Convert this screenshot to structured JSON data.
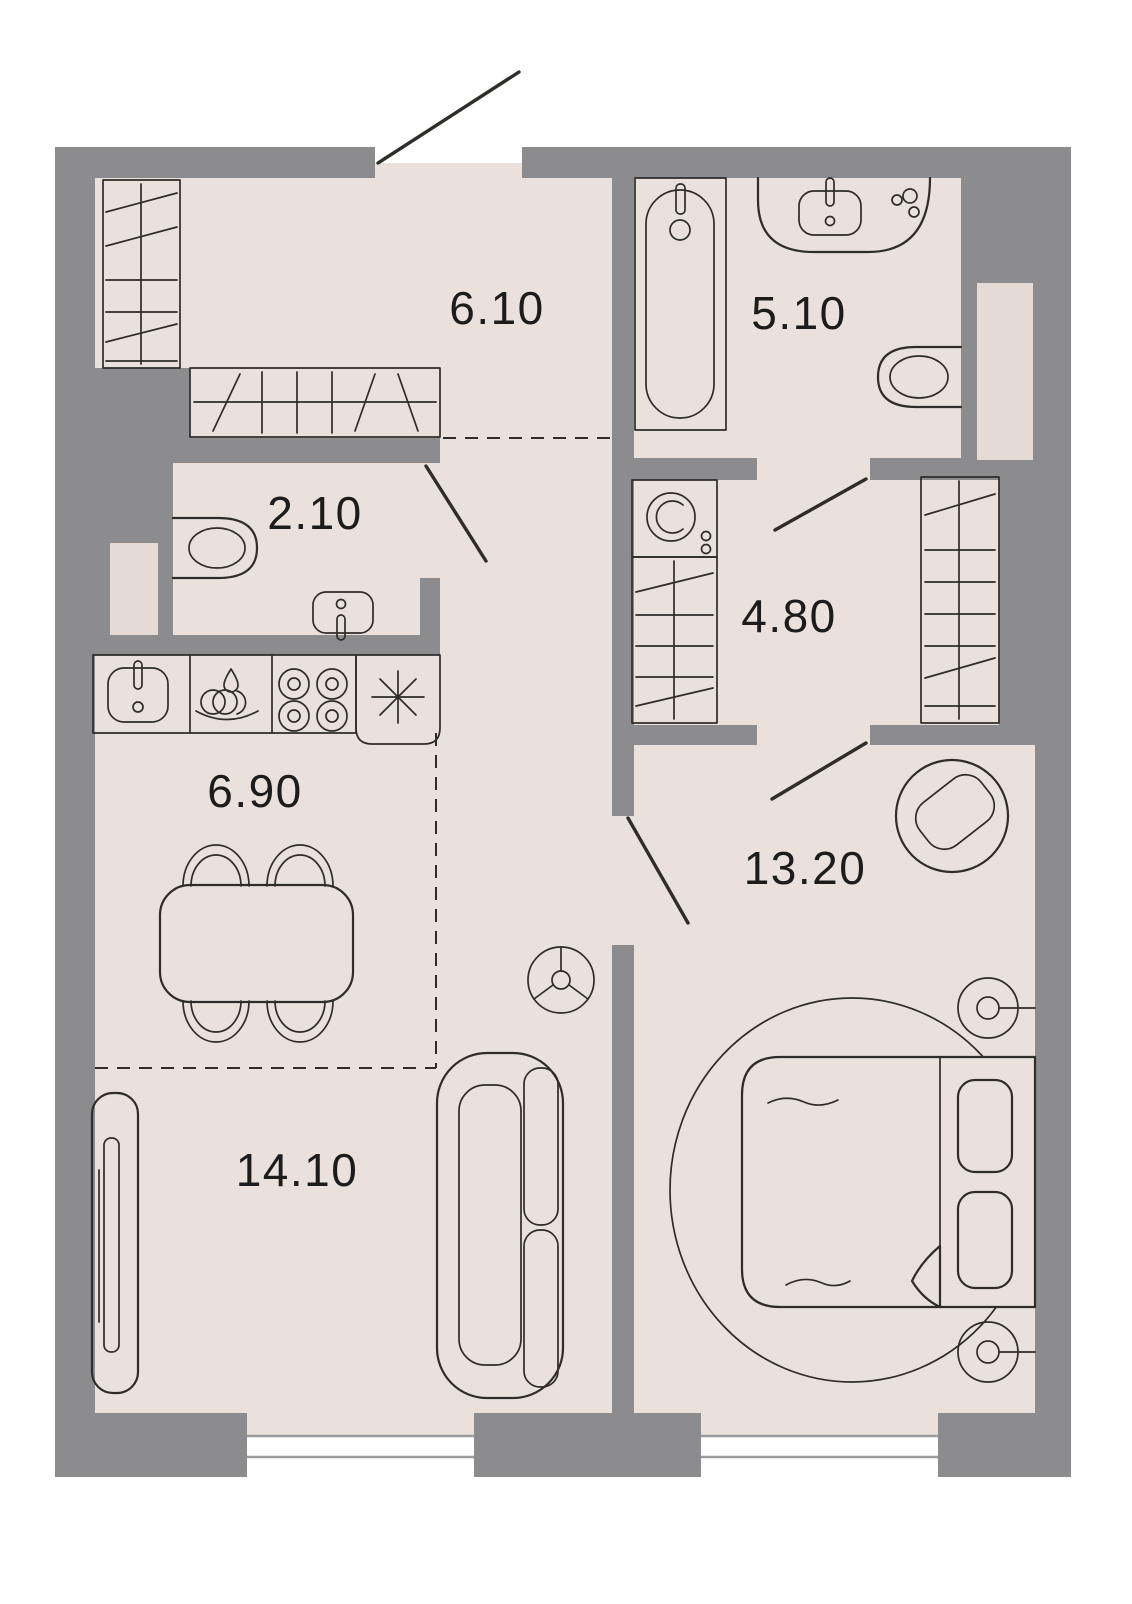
{
  "plan": {
    "colors": {
      "wall": "#8c8c8e",
      "floor": "#eae0dc",
      "shaft": "#e4dbd7",
      "line": "#2f2c29",
      "label": "#1c1c1c",
      "window": "#9b9b9d",
      "outside": "#ffffff"
    },
    "rooms": [
      {
        "id": "entrance-hall",
        "area": "6.10"
      },
      {
        "id": "bathroom",
        "area": "5.10"
      },
      {
        "id": "wc",
        "area": "2.10"
      },
      {
        "id": "dressing-room",
        "area": "4.80"
      },
      {
        "id": "kitchen",
        "area": "6.90"
      },
      {
        "id": "bedroom",
        "area": "13.20"
      },
      {
        "id": "living-room",
        "area": "14.10"
      }
    ],
    "icons": [
      "wardrobe-icon",
      "bathtub-icon",
      "bathroom-sink-icon",
      "toilet-icon",
      "soap-set-icon",
      "washing-machine-icon",
      "kitchen-sink-icon",
      "dish-rack-icon",
      "stove-icon",
      "fridge-icon",
      "dining-table-icon",
      "chair-icon",
      "sofa-icon",
      "tv-stand-icon",
      "ceiling-lamp-icon",
      "bed-icon",
      "pillow-icon",
      "rug-icon",
      "armchair-icon",
      "wall-lamp-icon",
      "door-swing-icon",
      "window-icon"
    ]
  }
}
